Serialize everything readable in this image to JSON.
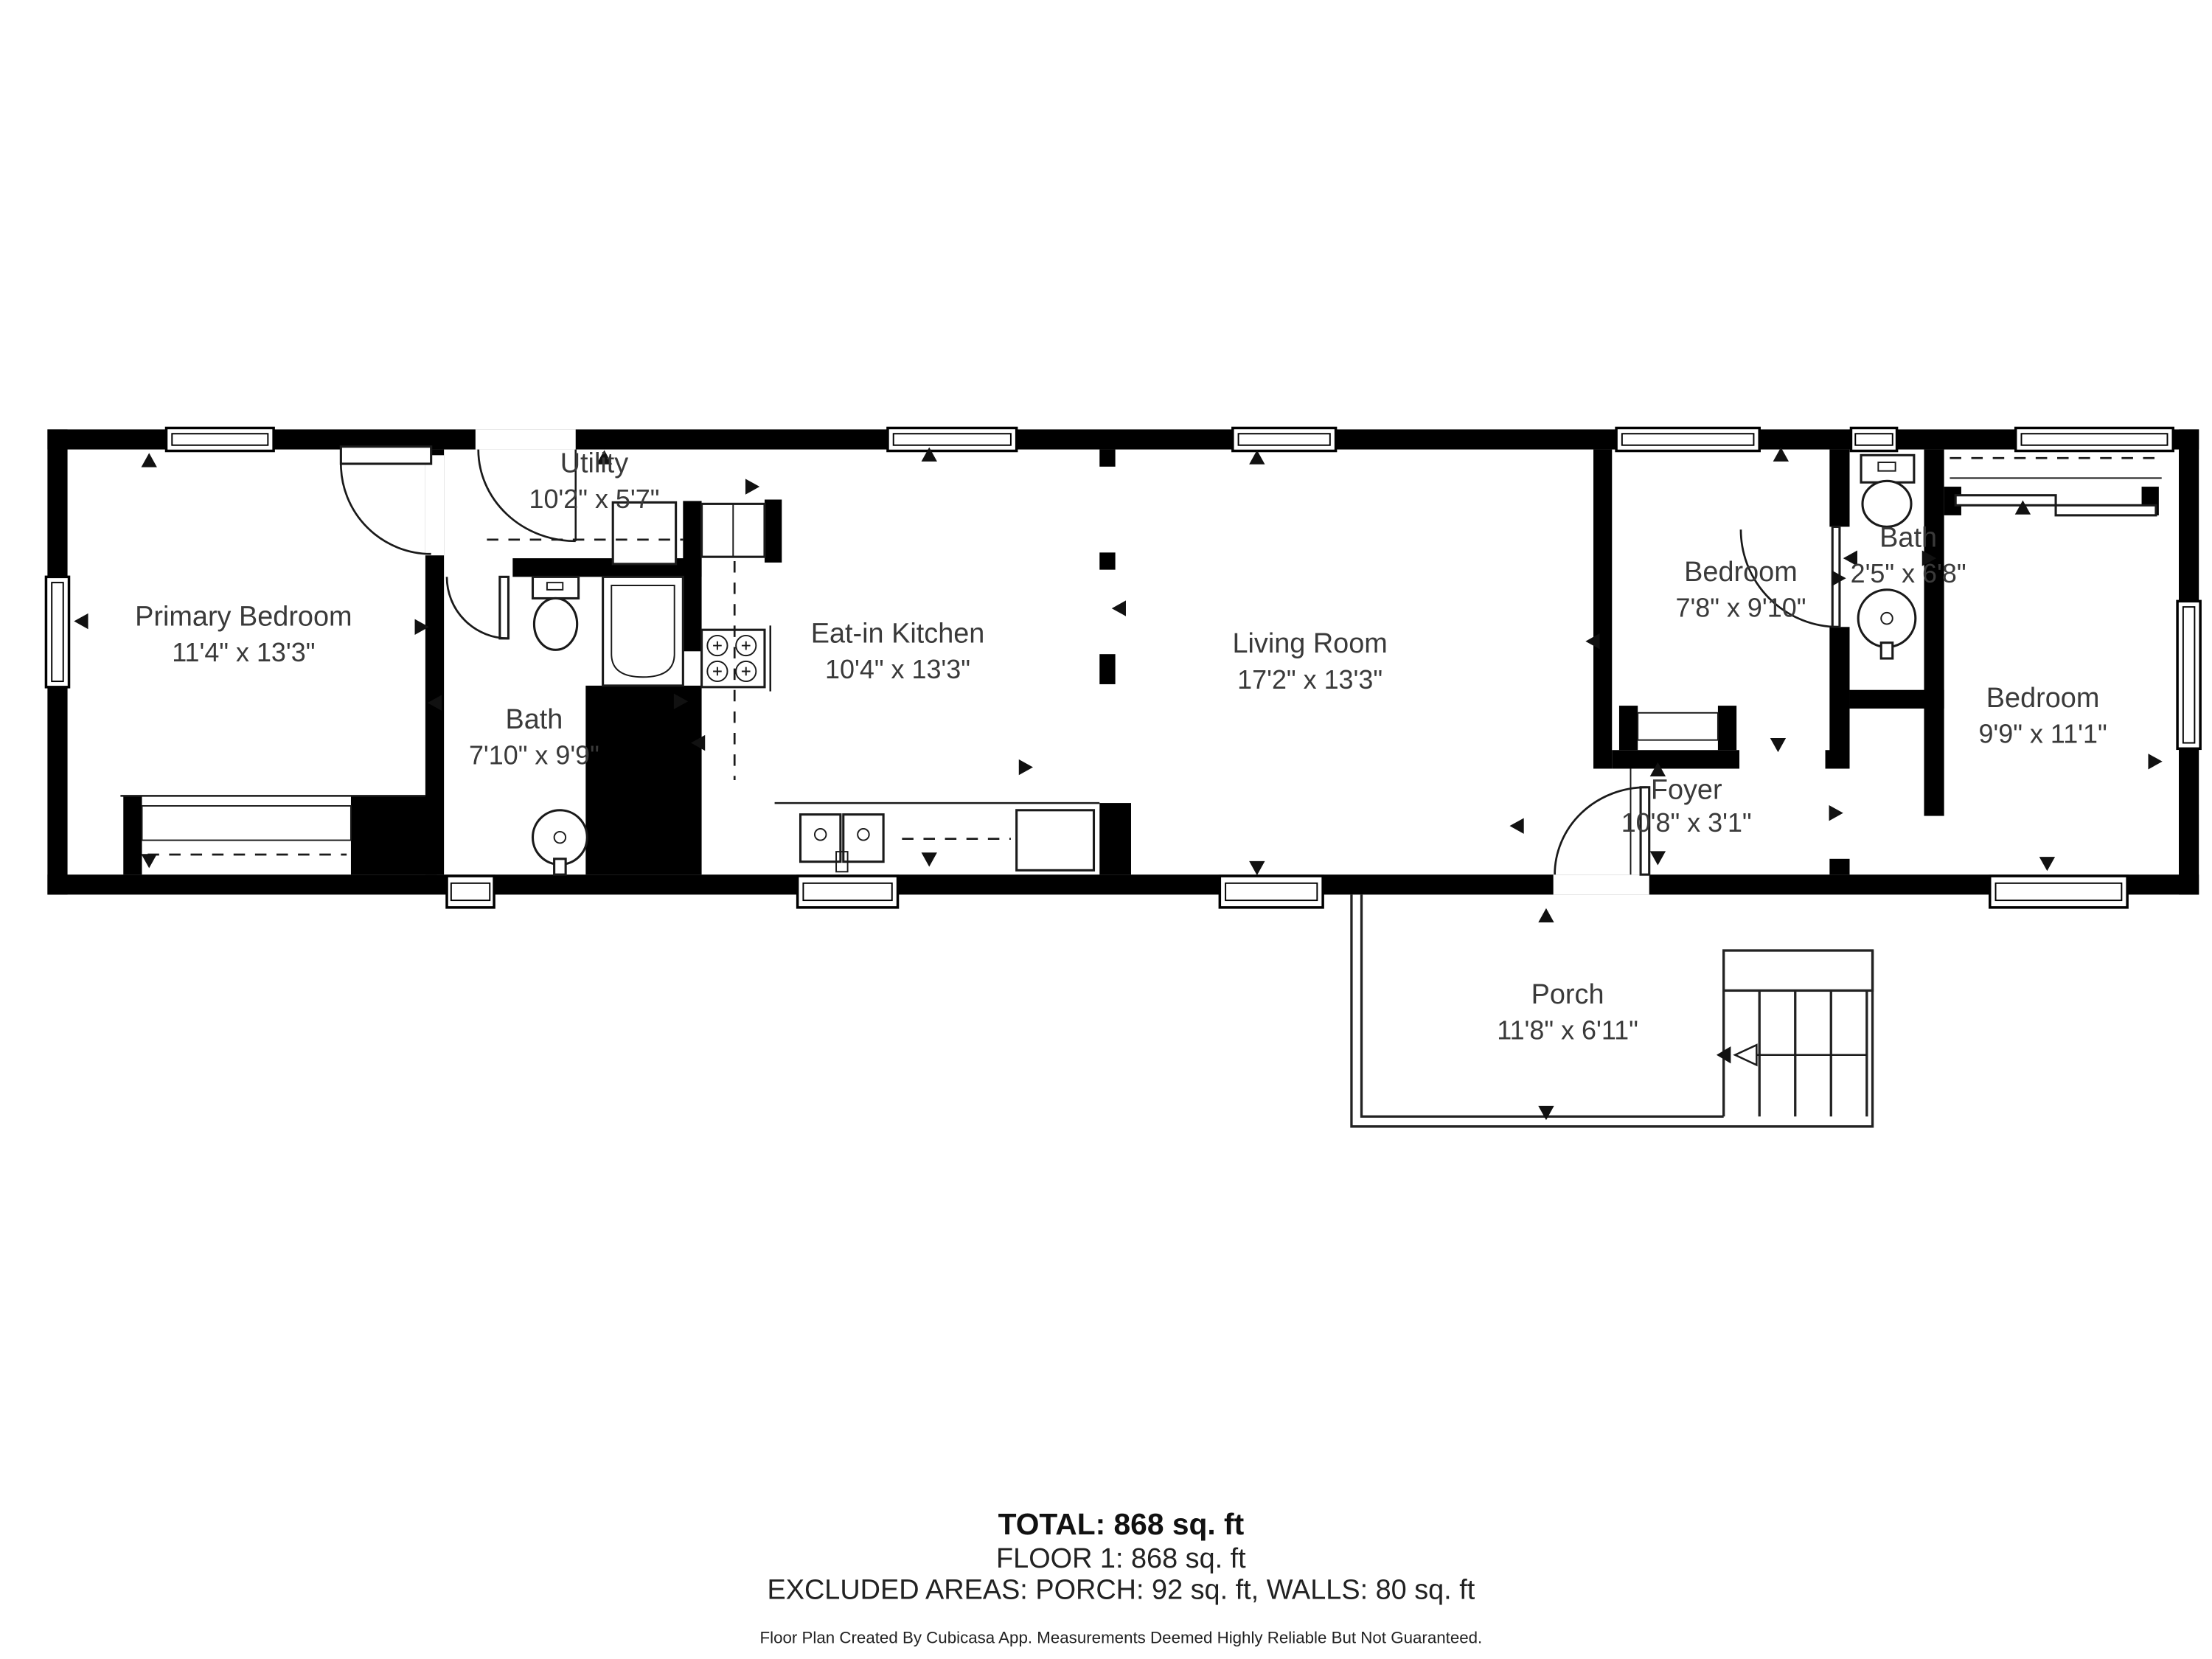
{
  "rooms": [
    {
      "id": "primary-bedroom",
      "name": "Primary Bedroom",
      "dims": "11'4\" x 13'3\""
    },
    {
      "id": "utility",
      "name": "Utility",
      "dims": "10'2\" x 5'7\""
    },
    {
      "id": "bath-1",
      "name": "Bath",
      "dims": "7'10\" x 9'9\""
    },
    {
      "id": "eat-in-kitchen",
      "name": "Eat-in Kitchen",
      "dims": "10'4\" x 13'3\""
    },
    {
      "id": "living-room",
      "name": "Living Room",
      "dims": "17'2\" x 13'3\""
    },
    {
      "id": "bedroom-2",
      "name": "Bedroom",
      "dims": "7'8\" x 9'10\""
    },
    {
      "id": "bath-2",
      "name": "Bath",
      "dims": "2'5\" x 6'8\""
    },
    {
      "id": "bedroom-3",
      "name": "Bedroom",
      "dims": "9'9\" x 11'1\""
    },
    {
      "id": "foyer",
      "name": "Foyer",
      "dims": "10'8\" x 3'1\""
    },
    {
      "id": "porch",
      "name": "Porch",
      "dims": "11'8\" x 6'11\""
    }
  ],
  "summary": {
    "total": "TOTAL: 868 sq. ft",
    "floor": "FLOOR 1: 868 sq. ft",
    "excluded": "EXCLUDED AREAS: PORCH: 92 sq. ft, WALLS: 80 sq. ft"
  },
  "disclaimer": "Floor Plan Created By Cubicasa App. Measurements Deemed Highly Reliable But Not Guaranteed.",
  "colors": {
    "wall": "#000000",
    "label": "#3a3a3a",
    "background": "#ffffff"
  }
}
